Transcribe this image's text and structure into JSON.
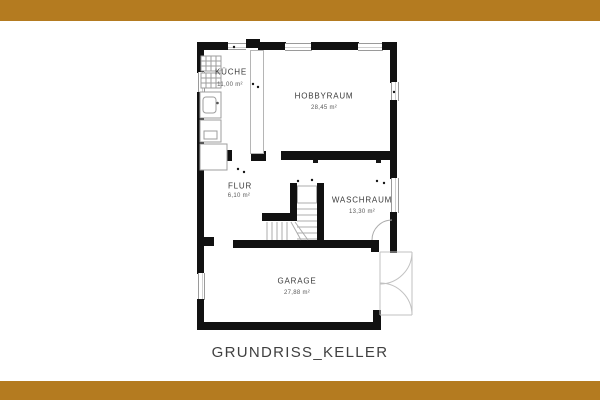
{
  "theme": {
    "accent_bar_color": "#b47b20",
    "background": "#ffffff",
    "wall_color": "#111111",
    "thin_line_color": "#b5b5b5",
    "text_color": "#3a3a3a"
  },
  "title": "GRUNDRISS_KELLER",
  "rooms": {
    "kueche": {
      "name": "KÜCHE",
      "area": "11,00 m²"
    },
    "hobbyraum": {
      "name": "HOBBYRAUM",
      "area": "28,45 m²"
    },
    "flur": {
      "name": "FLUR",
      "area": "6,10 m²"
    },
    "waschraum": {
      "name": "WASCHRAUM",
      "area": "13,30 m²"
    },
    "garage": {
      "name": "GARAGE",
      "area": "27,88 m²"
    }
  }
}
